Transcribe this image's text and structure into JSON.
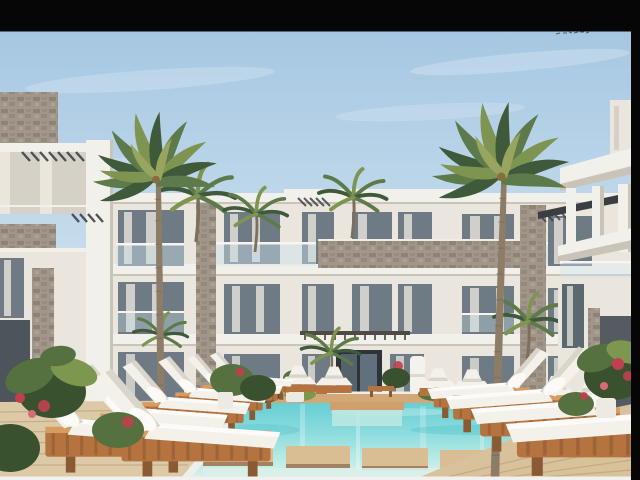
{
  "scene": {
    "kind": "architectural-render-photo",
    "description": "3D exterior render of a modern white three-storey resort apartment block behind a turquoise swimming pool, two tall palm trees, rows of white sun loungers on teak bases, wooden deck and floating step platforms, tropical plants with red bougainvillea, letterboxed with black bars on top and right and a pale strip at the bottom.",
    "regions": {
      "letterbox_top": "black bar",
      "letterbox_right": "black bar",
      "bottom_strip": "pale strip",
      "sky": "hazy light-blue sky with faint cloud streaks",
      "birds_watermark": "tiny dark specks in sky, upper right",
      "left_building": "white side building with stone bands, slate panel, pergola slats",
      "main_building": "central three-storey white block, glass balustrades, stone-clad accents, sheer curtains",
      "right_building": "near white building with columns, slabs, charcoal panel",
      "palm_left": "tall palm in front of left wing",
      "palm_right": "tall palm in front of right wing",
      "pool": "turquoise pool with wooden float steps and in-pool platform",
      "deck_left": "wooden deck, lower left",
      "deck_right": "wooden deck, lower right",
      "loungers_left": "fan of white loungers on teak bases, left",
      "loungers_right": "fan of white loungers on teak bases, right",
      "loungers_far": "small loungers along far pool edge",
      "plants": "tropical shrubs, planters and red flowers"
    }
  },
  "colors": {
    "black_bar": "#060606",
    "bottom_strip": "#f1f1ef",
    "sky_top": "#a6c7e2",
    "sky_mid": "#c6dcec",
    "sky_horizon": "#e7eff4",
    "wall_light": "#eae6de",
    "wall_bright": "#f2f0ea",
    "wall_shadow": "#d6d1c7",
    "wall_deep": "#c9c3b8",
    "stone": "#a1968a",
    "stone_dark": "#7d7265",
    "slate": "#4e545c",
    "charcoal": "#565b62",
    "glass": "#6e7b85",
    "glass_dark": "#2e3338",
    "curtain": "#e9e5dd",
    "rail_glass": "#cfe3ea",
    "palm_dark": "#3e5a3a",
    "palm_mid": "#5d7b4a",
    "palm_light": "#7e9552",
    "palm_pale": "#98a55e",
    "trunk": "#8d7d67",
    "trunk_dark": "#6e6150",
    "water_deep": "#62cdd2",
    "water_mid": "#8eddde",
    "water_light": "#bfece6",
    "water_pale": "#d9efe9",
    "wood_frame": "#b5743f",
    "wood_dark": "#8a5a32",
    "wood_hi": "#d89c60",
    "coping": "#d2a976",
    "deck": "#dcc9a6",
    "deck_line": "#c5ae88",
    "platform": "#d9bd93",
    "cushion": "#f3f1ea",
    "cushion_shadow": "#d9d5ca",
    "plant": "#55713f",
    "plant_dark": "#39512f",
    "plant_hi": "#7e974f",
    "flower": "#c2404e",
    "pergola": "#3f4347",
    "birds": "#3a3a3a"
  }
}
